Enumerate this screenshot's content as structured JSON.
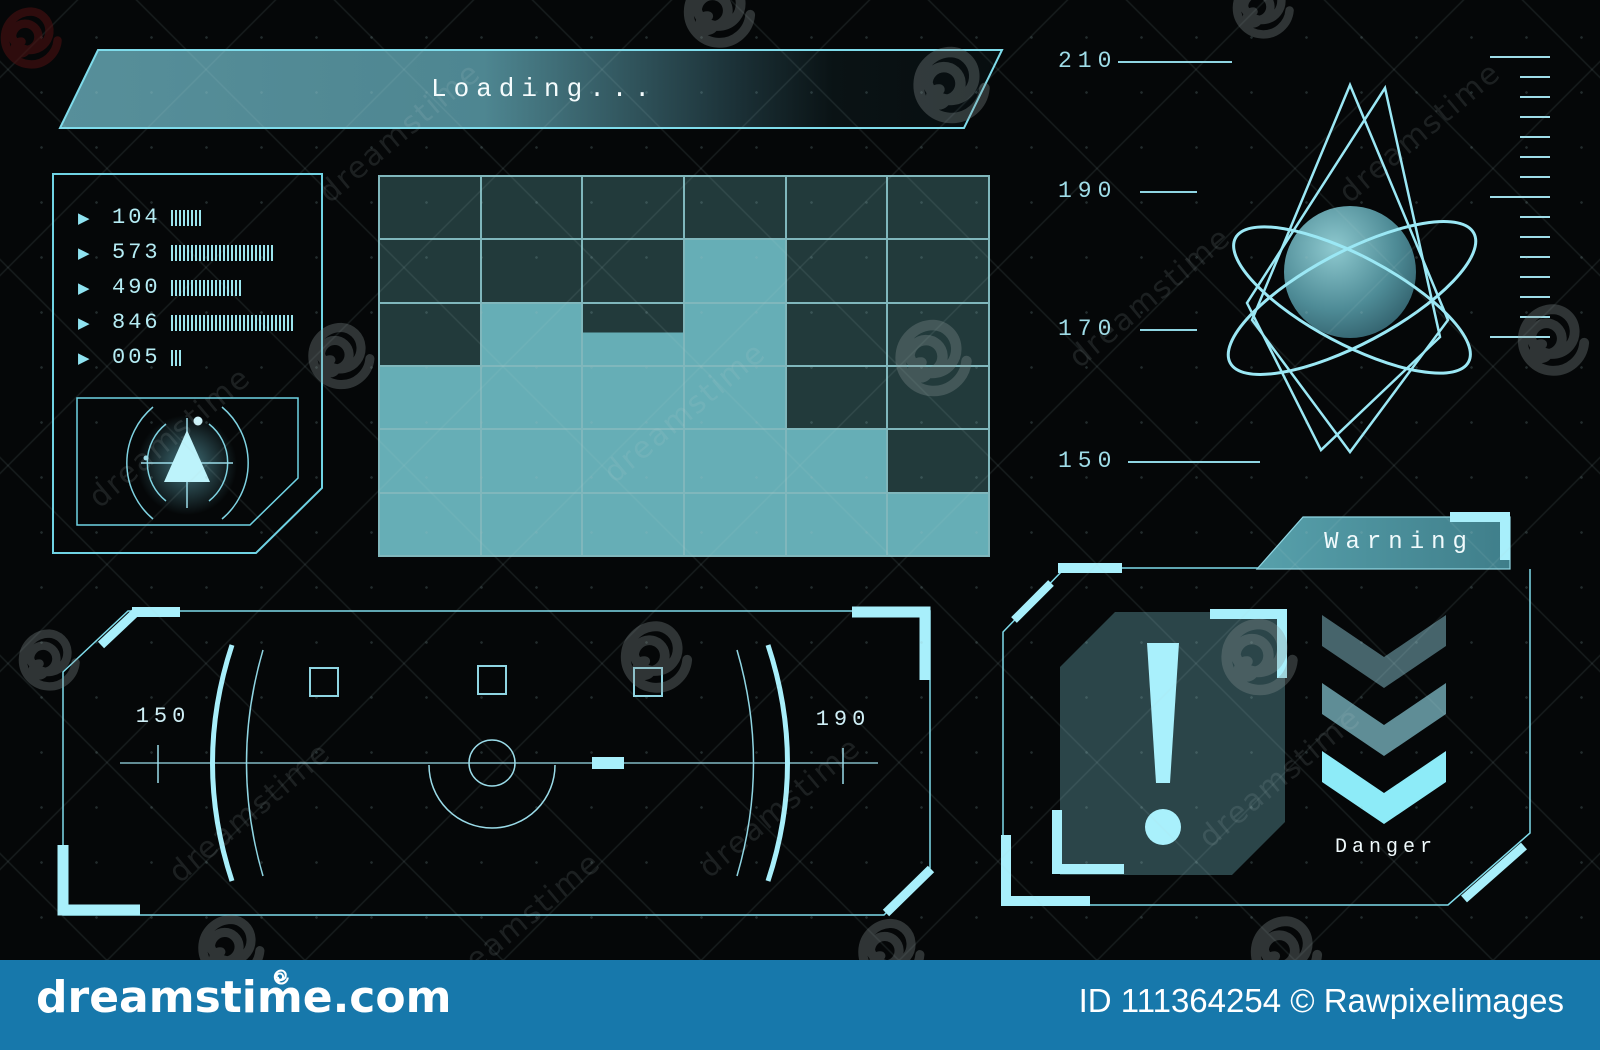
{
  "loading_banner": {
    "label": "Loading..."
  },
  "signal_list": {
    "items": [
      {
        "value": "104",
        "ticks": 8
      },
      {
        "value": "573",
        "ticks": 26
      },
      {
        "value": "490",
        "ticks": 18
      },
      {
        "value": "846",
        "ticks": 31
      },
      {
        "value": "005",
        "ticks": 3
      }
    ]
  },
  "block_grid": {
    "columns": 6,
    "rows": 6,
    "legend": {
      "D": "dark-cell",
      "L": "lit-cell",
      "H": "half-lit-cell"
    },
    "cells": [
      [
        "D",
        "D",
        "D",
        "D",
        "D",
        "D"
      ],
      [
        "D",
        "D",
        "D",
        "L",
        "D",
        "D"
      ],
      [
        "D",
        "L",
        "H",
        "L",
        "D",
        "D"
      ],
      [
        "L",
        "L",
        "L",
        "L",
        "D",
        "D"
      ],
      [
        "L",
        "L",
        "L",
        "L",
        "L",
        "D"
      ],
      [
        "L",
        "L",
        "L",
        "L",
        "L",
        "L"
      ]
    ],
    "lit_cells_per_column_from_bottom": [
      3,
      4,
      3.5,
      5,
      2,
      1
    ]
  },
  "scale_axis": {
    "ticks": [
      {
        "label": "210"
      },
      {
        "label": "190"
      },
      {
        "label": "170"
      },
      {
        "label": "150"
      }
    ]
  },
  "ruler": {
    "tick_count": 15,
    "major_every": 7
  },
  "gauge_panel": {
    "left_label": "150",
    "right_label": "190"
  },
  "warning_panel": {
    "title": "Warning",
    "caption": "Danger"
  },
  "watermark": {
    "site": "dreamstime.com",
    "credit": "ID 111364254 © Rawpixelimages",
    "name": "dreamstime"
  },
  "colors": {
    "accent_line": "#79d7e6",
    "accent_bright": "#a8effb",
    "text_cyan": "#b5ecf4",
    "grid_light": "#66aeb6",
    "grid_dark": "#223a3b",
    "grid_line": "#9fe4ea",
    "panel_fill": "#2b4549",
    "banner_teal": "#4f939e",
    "chevrons": [
      "#46646b",
      "#5f8d96",
      "#8debf8"
    ],
    "credit_bar_blue": "#1778ab"
  }
}
